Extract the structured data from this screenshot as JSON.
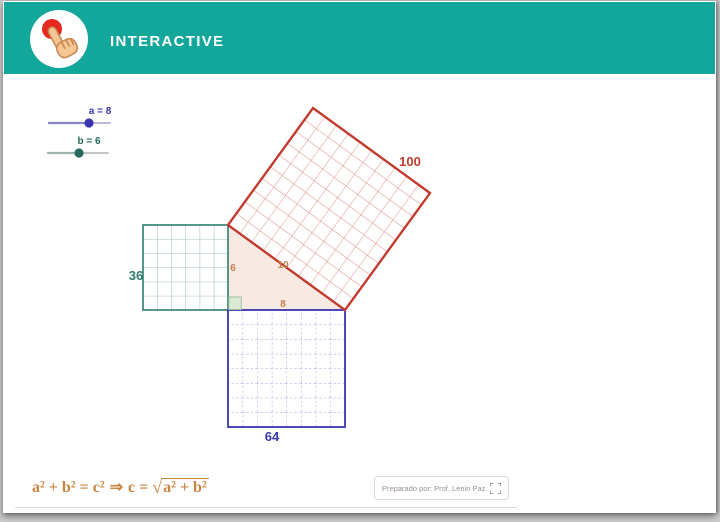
{
  "header": {
    "title": "INTERACTIVE",
    "bg_color": "#13A69B",
    "logo": {
      "icon": "hand-click-icon",
      "dot_color": "#E6281E",
      "hand_color": "#F6C795"
    }
  },
  "sliders": {
    "a": {
      "label": "a = 8",
      "value": 8,
      "color": "#3A35B0"
    },
    "b": {
      "label": "b = 6",
      "value": 6,
      "color": "#256A5C"
    }
  },
  "figure": {
    "type": "pythagorean-theorem-proof",
    "triangle_sides": {
      "vertical_leg": "6",
      "horizontal_leg": "8",
      "hypotenuse": "10"
    },
    "side_label_color": "#C77F4F",
    "triangle_fill": "#F6EAE3",
    "squares": {
      "green": {
        "area_label": "36",
        "side_units": 6,
        "color": "#2E7D6E"
      },
      "blue": {
        "area_label": "64",
        "side_units": 8,
        "color": "#3A35B0"
      },
      "red": {
        "area_label": "100",
        "side_units": 10,
        "color": "#C23B2E"
      }
    }
  },
  "formula": {
    "lhs": "a² + b² = c²",
    "implies": "⇒",
    "mid": "c =",
    "radical": "√",
    "radicand": "a² + b²",
    "color": "#C8853F"
  },
  "footer": {
    "credit": "Preparado por: Prof. Lenin Paz",
    "fullscreen_icon": "fullscreen-icon"
  }
}
